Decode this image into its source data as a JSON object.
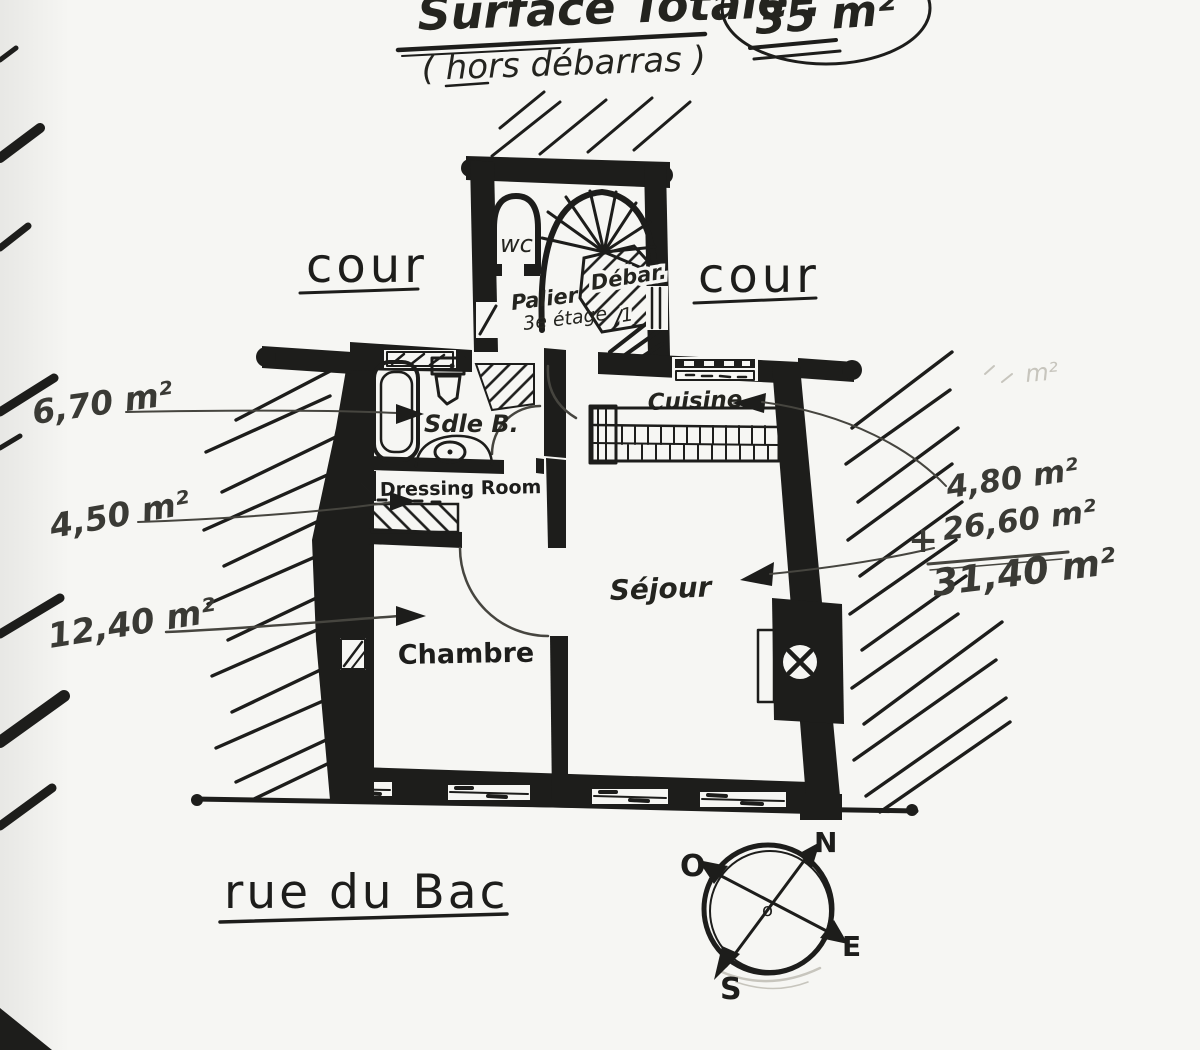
{
  "title": {
    "main": "Surface Totale :",
    "value": "35 m²",
    "subtitle": "( hors débarras )"
  },
  "courtyards": {
    "left": "cour",
    "right": "cour"
  },
  "street": "rue du Bac",
  "rooms": {
    "wc": "wc",
    "debar": "Débar.",
    "debar_num": "1",
    "palier_line1": "Palier",
    "palier_line2": "3e étage",
    "bath": "Sdle B.",
    "dressing": "Dressing Room",
    "bedroom": "Chambre",
    "living": "Séjour",
    "kitchen": "Cuisine"
  },
  "areas": {
    "bath": "6,70 m²",
    "dressing": "4,50 m²",
    "bedroom": "12,40 m²",
    "kitchen": "4,80 m²",
    "plus": "+",
    "living": "26,60 m²",
    "total": "31,40 m²"
  },
  "compass": {
    "n": "N",
    "o": "O",
    "e": "E",
    "s": "S",
    "center": "o"
  },
  "faint_note": "m²",
  "colors": {
    "ink": "#1d1d1b",
    "pencil": "#3a3a35",
    "paper": "#f6f6f3"
  }
}
